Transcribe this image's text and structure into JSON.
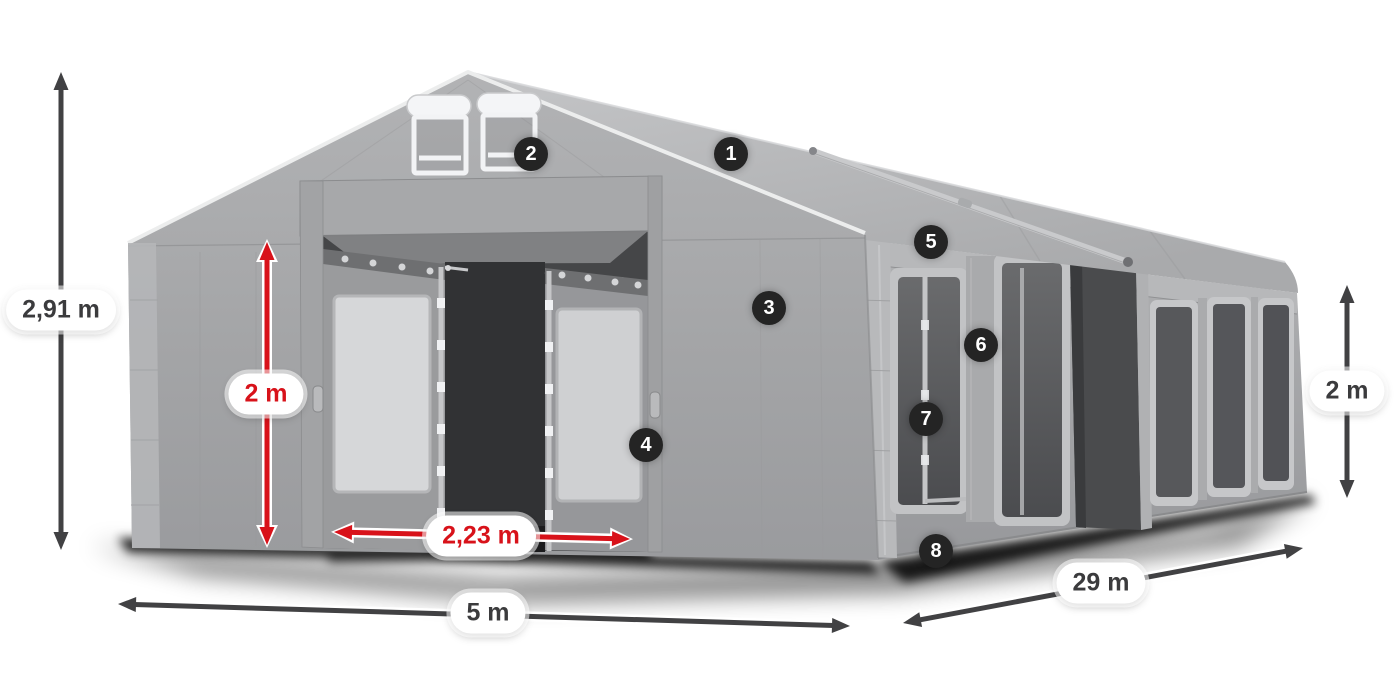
{
  "canvas": {
    "width": 1400,
    "height": 700,
    "background": "#ffffff"
  },
  "colors": {
    "accent_red": "#d8121a",
    "dim_dark": "#414143",
    "marker_bg": "#242424",
    "marker_text": "#ffffff",
    "pill_bg": "#ffffff",
    "pill_text_dark": "#3b3b3d",
    "tent_gray": "#a7a8aa",
    "window_glass": "#55565a",
    "ground_shadow": "#0a0a0a"
  },
  "markers": [
    {
      "number": "1",
      "x": 731,
      "y": 154
    },
    {
      "number": "2",
      "x": 531,
      "y": 154
    },
    {
      "number": "3",
      "x": 769,
      "y": 308
    },
    {
      "number": "4",
      "x": 646,
      "y": 445
    },
    {
      "number": "5",
      "x": 931,
      "y": 242
    },
    {
      "number": "6",
      "x": 981,
      "y": 345
    },
    {
      "number": "7",
      "x": 926,
      "y": 419
    },
    {
      "number": "8",
      "x": 936,
      "y": 551
    }
  ],
  "dimensions": [
    {
      "id": "total-height",
      "label": "2,91 m",
      "style": "dark",
      "x1": 61,
      "y1": 72,
      "x2": 61,
      "y2": 550,
      "lx": 61,
      "ly": 310
    },
    {
      "id": "entrance-height",
      "label": "2 m",
      "style": "red",
      "x1": 267,
      "y1": 242,
      "x2": 267,
      "y2": 545,
      "lx": 266,
      "ly": 394
    },
    {
      "id": "entrance-width",
      "label": "2,23 m",
      "style": "red",
      "x1": 334,
      "y1": 532,
      "x2": 630,
      "y2": 539,
      "lx": 481,
      "ly": 536
    },
    {
      "id": "front-width",
      "label": "5 m",
      "style": "dark",
      "x1": 118,
      "y1": 604,
      "x2": 850,
      "y2": 626,
      "lx": 488,
      "ly": 613
    },
    {
      "id": "side-length",
      "label": "29 m",
      "style": "dark",
      "x1": 903,
      "y1": 623,
      "x2": 1303,
      "y2": 548,
      "lx": 1101,
      "ly": 583
    },
    {
      "id": "side-wall-height",
      "label": "2 m",
      "style": "dark",
      "x1": 1347,
      "y1": 285,
      "x2": 1347,
      "y2": 498,
      "lx": 1347,
      "ly": 391
    }
  ]
}
